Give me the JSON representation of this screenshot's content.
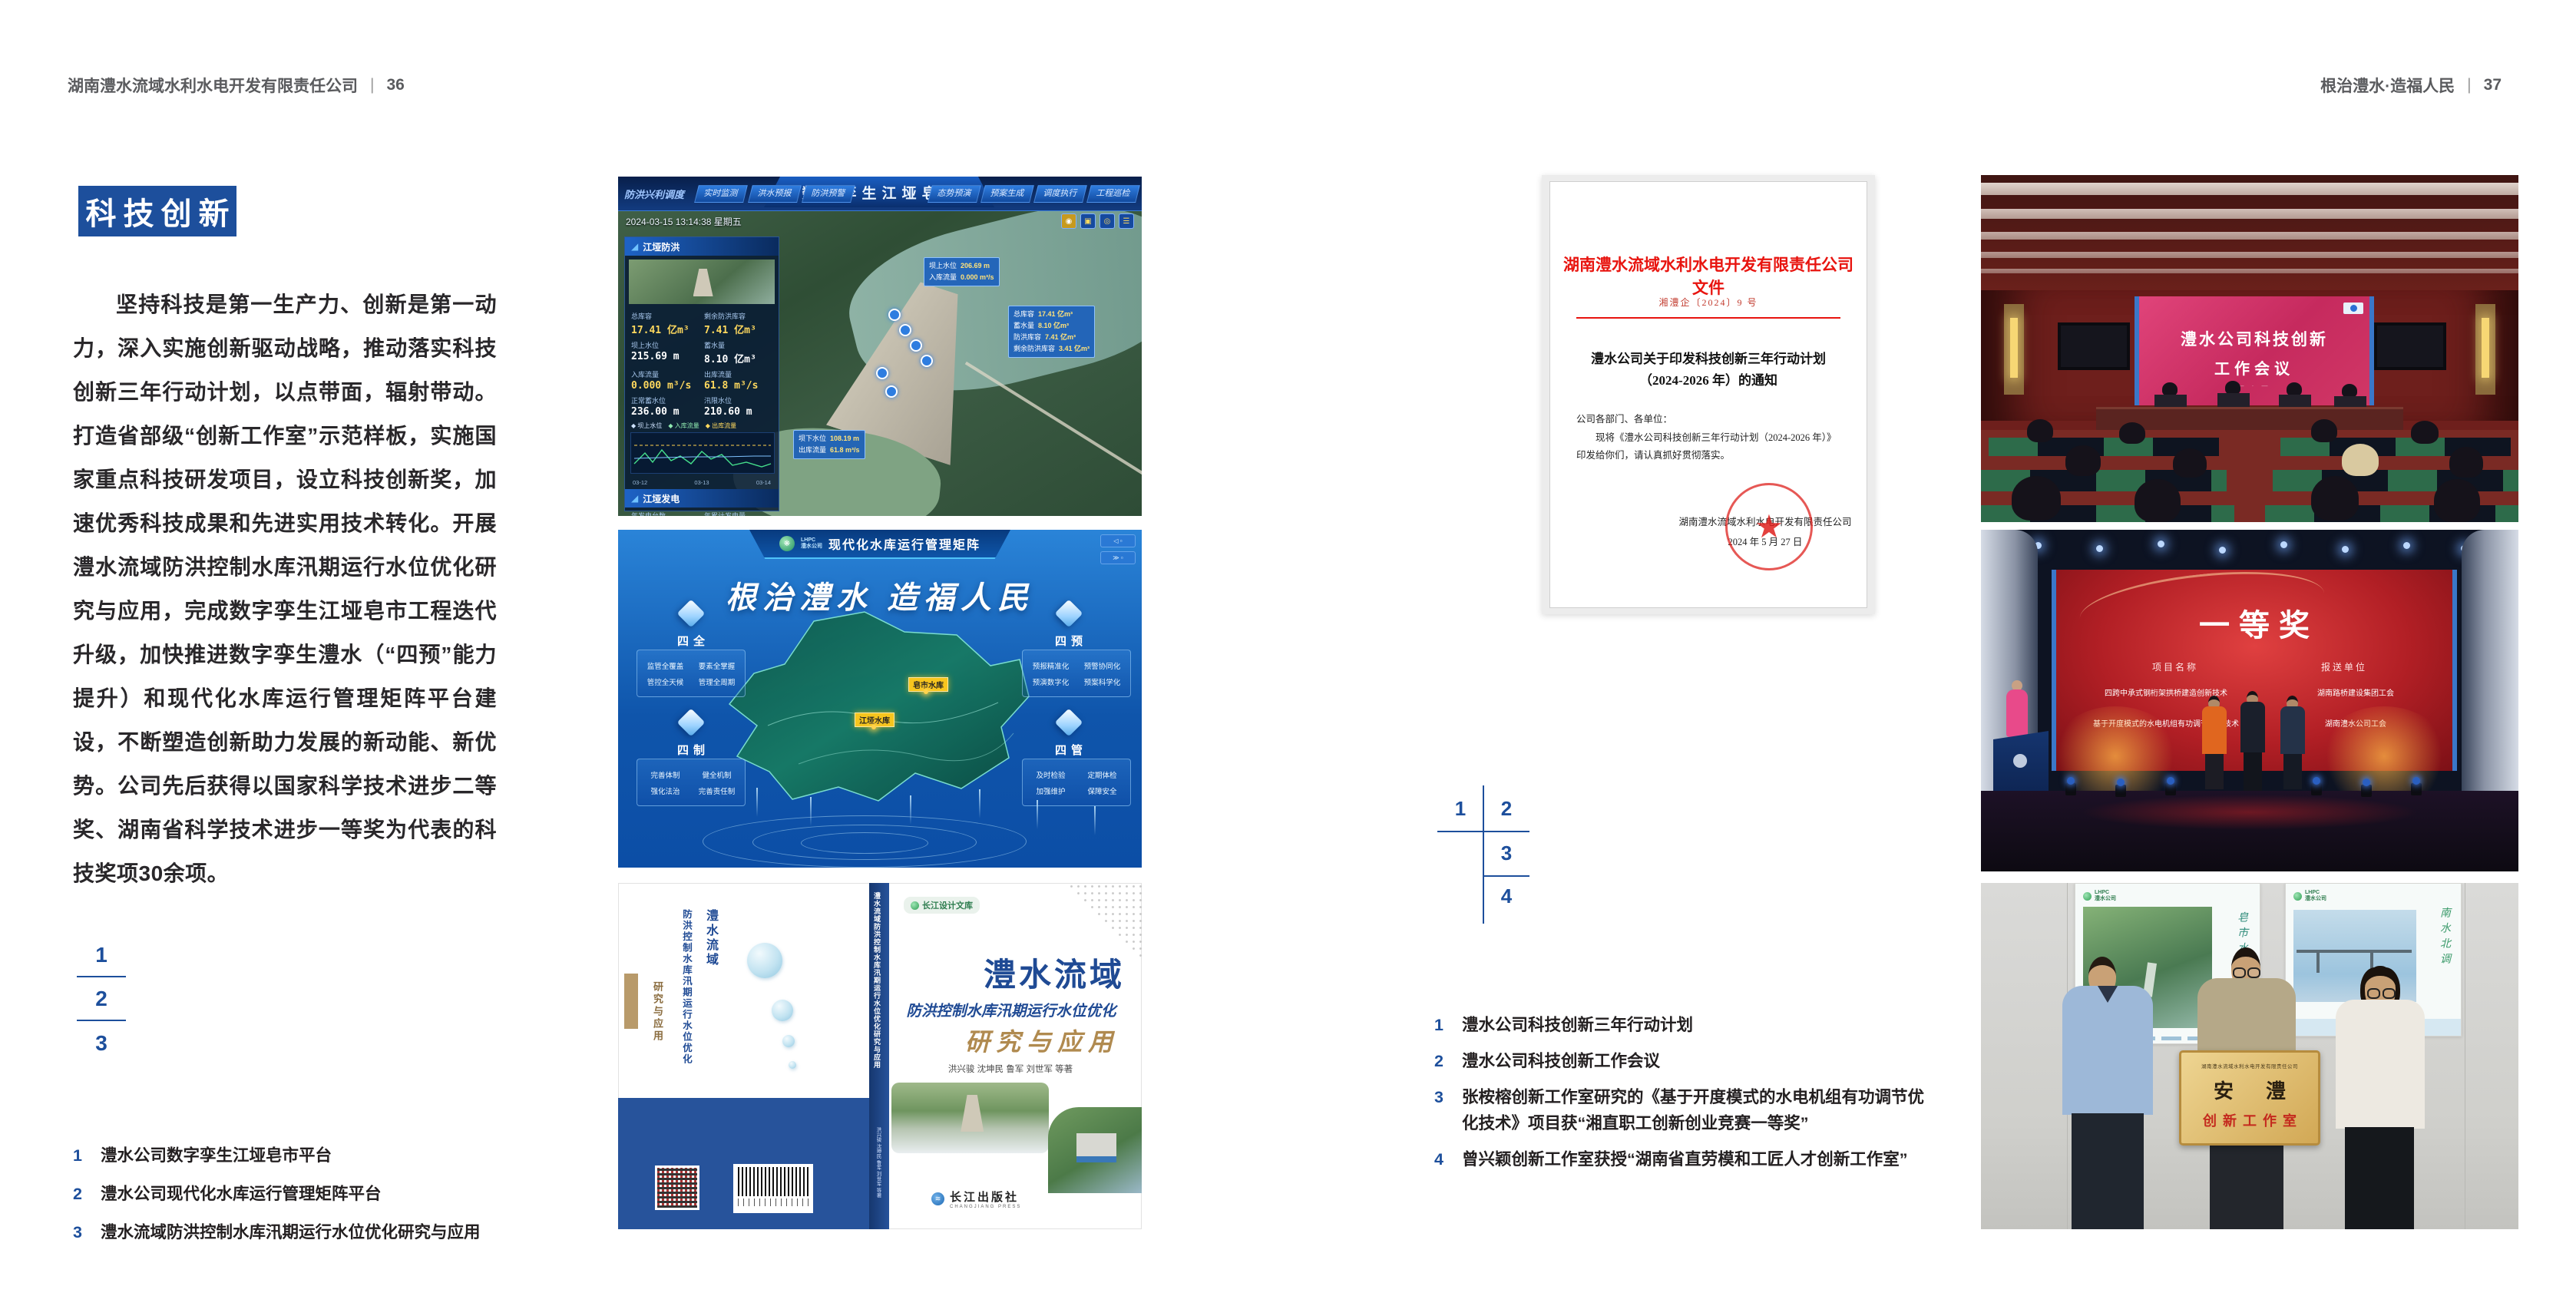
{
  "left_page": {
    "header": {
      "company": "湖南澧水流域水利水电开发有限责任公司",
      "sep": "|",
      "page": "36"
    },
    "section_title": "科技创新",
    "body": "坚持科技是第一生产力、创新是第一动力，深入实施创新驱动战略，推动落实科技创新三年行动计划，以点带面，辐射带动。打造省部级“创新工作室”示范样板，实施国家重点科技研发项目，设立科技创新奖，加速优秀科技成果和先进实用技术转化。开展澧水流域防洪控制水库汛期运行水位优化研究与应用，完成数字孪生江垭皂市工程迭代升级，加快推进数字孪生澧水（“四预”能力提升）和现代化水库运行管理矩阵平台建设，不断塑造创新助力发展的新动能、新优势。公司先后获得以国家科学技术进步二等奖、湖南省科学技术进步一等奖为代表的科技奖项30余项。",
    "index_numbers": [
      "1",
      "2",
      "3"
    ],
    "captions": [
      {
        "num": "1",
        "text": "澧水公司数字孪生江垭皂市平台"
      },
      {
        "num": "2",
        "text": "澧水公司现代化水库运行管理矩阵平台"
      },
      {
        "num": "3",
        "text": "澧水流域防洪控制水库汛期运行水位优化研究与应用"
      }
    ],
    "fig_twin": {
      "corner_label": "防洪兴利调度",
      "title": "数字孪生江垭皂市",
      "tabs_left": [
        "实时监测",
        "洪水预报",
        "防洪预警"
      ],
      "tabs_right": [
        "态势预演",
        "预案生成",
        "调度执行",
        "工程巡检"
      ],
      "timestamp": "2024-03-15 13:14:38 星期五",
      "panel_flood": {
        "title": "江垭防洪",
        "stats": [
          {
            "label": "总库容",
            "value": "17.41 亿m³"
          },
          {
            "label": "剩余防洪库容",
            "value": "7.41 亿m³"
          },
          {
            "label": "坝上水位",
            "value": "215.69 m"
          },
          {
            "label": "蓄水量",
            "value": "8.10 亿m³"
          },
          {
            "label": "入库流量",
            "value": "0.000 m³/s"
          },
          {
            "label": "出库流量",
            "value": "61.8 m³/s"
          },
          {
            "label": "正常蓄水位",
            "value": "236.00 m"
          },
          {
            "label": "汛限水位",
            "value": "210.60 m"
          }
        ],
        "legend": [
          "坝上水位",
          "入库流量",
          "出库流量"
        ],
        "chart_xticks": [
          "03-12",
          "03-13",
          "03-14"
        ]
      },
      "panel_power": {
        "title": "江垭发电",
        "stats": [
          {
            "label": "年发电台数",
            "value": "6.3000"
          },
          {
            "label": "年累计发电量",
            "value": "1.2907"
          },
          {
            "label": "月累计发电量",
            "value": "3359.21"
          },
          {
            "label": "当前出力",
            "value": "0.00 MW"
          }
        ]
      },
      "tooltip_up": [
        {
          "label": "坝上水位",
          "value": "206.69 m"
        },
        {
          "label": "入库流量",
          "value": "0.000 m³/s"
        }
      ],
      "tooltip_cap": [
        {
          "label": "总库容",
          "value": "17.41 亿m³"
        },
        {
          "label": "蓄水量",
          "value": "8.10 亿m³"
        },
        {
          "label": "防洪库容",
          "value": "7.41 亿m³"
        },
        {
          "label": "剩余防洪库容",
          "value": "3.41 亿m³"
        }
      ],
      "tooltip_down": [
        {
          "label": "坝下水位",
          "value": "108.19 m"
        },
        {
          "label": "出库流量",
          "value": "61.8 m³/s"
        }
      ]
    },
    "fig_matrix": {
      "logo_abbr": "LHPC",
      "logo_name": "澧水公司",
      "title": "现代化水库运行管理矩阵",
      "slogan": "根治澧水  造福人民",
      "groups": [
        {
          "name": "四全",
          "items": [
            "监管全覆盖",
            "要素全掌握",
            "管控全天候",
            "管理全周期"
          ]
        },
        {
          "name": "四预",
          "items": [
            "预报精准化",
            "预警协同化",
            "预演数字化",
            "预案科学化"
          ]
        },
        {
          "name": "四制",
          "items": [
            "完善体制",
            "健全机制",
            "强化法治",
            "完善责任制"
          ]
        },
        {
          "name": "四管",
          "items": [
            "及时检验",
            "定期体检",
            "加强维护",
            "保障安全"
          ]
        }
      ],
      "markers": [
        "江垭水库",
        "皂市水库"
      ]
    },
    "fig_book": {
      "series": "长江设计文库",
      "title1": "澧水流域",
      "title2": "防洪控制水库汛期运行水位优化",
      "title3": "研究与应用",
      "authors": "洪兴骏  沈坤民  鲁军  刘世军  等著",
      "publisher": "长江出版社",
      "publisher_en": "CHANGJIANG PRESS",
      "spine": "澧水流域防洪控制水库汛期运行水位优化研究与应用"
    }
  },
  "right_page": {
    "header": {
      "slogan": "根治澧水·造福人民",
      "sep": "|",
      "page": "37"
    },
    "document": {
      "heading": "湖南澧水流域水利水电开发有限责任公司文件",
      "doc_no": "湘澧企〔2024〕9 号",
      "title1": "澧水公司关于印发科技创新三年行动计划",
      "title2": "（2024-2026 年）的通知",
      "salutation": "公司各部门、各单位：",
      "body": "现将《澧水公司科技创新三年行动计划（2024-2026 年）》印发给你们，请认真抓好贯彻落实。",
      "signer": "湖南澧水流域水利水电开发有限责任公司",
      "date": "2024 年 5 月 27 日"
    },
    "index_numbers": [
      "1",
      "2",
      "3",
      "4"
    ],
    "captions": [
      {
        "num": "1",
        "text": "澧水公司科技创新三年行动计划"
      },
      {
        "num": "2",
        "text": "澧水公司科技创新工作会议"
      },
      {
        "num": "3",
        "text": "张桉榕创新工作室研究的《基于开度模式的水电机组有功调节优化技术》项目获“湘直职工创新创业竞赛一等奖”"
      },
      {
        "num": "4",
        "text": "曾兴颖创新工作室获授“湖南省直劳模和工匠人才创新工作室”"
      }
    ],
    "photo_meeting": {
      "screen_line1": "澧水公司科技创新",
      "screen_line2": "工作会议"
    },
    "photo_award": {
      "title": "一等奖",
      "col_project": "项目名称",
      "col_unit": "报送单位",
      "rows": [
        {
          "project": "四跨中承式钢桁架拱桥建造创新技术",
          "unit": "湖南路桥建设集团工会"
        },
        {
          "project": "基于开度模式的水电机组有功调节优化技术",
          "unit": "湖南澧水公司工会"
        }
      ]
    },
    "photo_plaque": {
      "poster_left_caption": "皂市水库",
      "poster_right_caption": "南水北调",
      "logo_abbr": "LHPC",
      "logo_name": "澧水公司",
      "plaque_top": "湖南澧水流域水利水电开发有限责任公司",
      "plaque_main": "安澧",
      "plaque_sub": "创新工作室"
    }
  },
  "colors": {
    "accent_blue": "#1d4f9c",
    "doc_red": "#e8140f",
    "award_red": "#b21f25",
    "gold": "#d2a855"
  }
}
